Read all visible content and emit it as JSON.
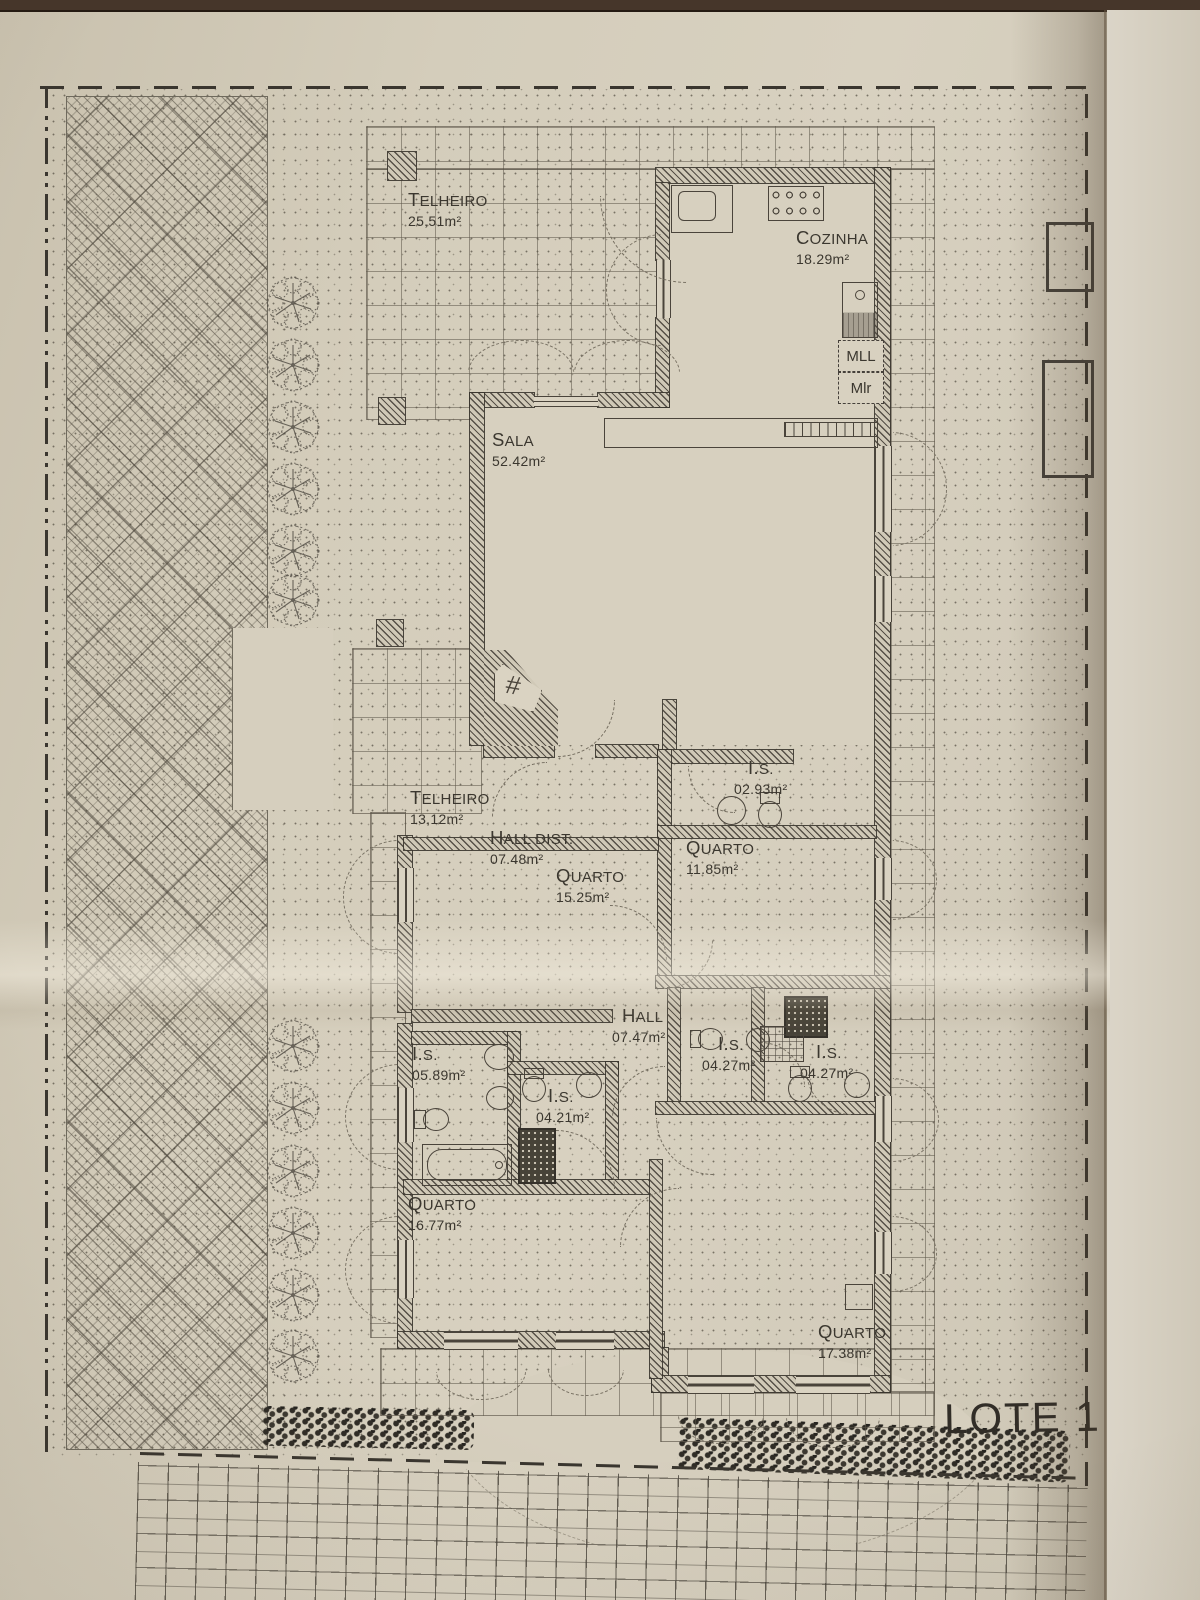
{
  "site": {
    "lote1": "LOTE 1",
    "lote2": "LOTE 2"
  },
  "kitchen_labels": {
    "mll": "MLL",
    "mlr": "Mlr"
  },
  "symbols": {
    "hash": "#"
  },
  "rooms": [
    {
      "name": "TELHEIRO",
      "area": "25,51m²"
    },
    {
      "name": "COZINHA",
      "area": "18.29m²"
    },
    {
      "name": "SALA",
      "area": "52.42m²"
    },
    {
      "name": "TELHEIRO",
      "area": "13,12m²"
    },
    {
      "name": "HALL DIST.",
      "area": "07.48m²"
    },
    {
      "name": "QUARTO",
      "area": "15.25m²"
    },
    {
      "name": "I.S.",
      "area": "02.93m²"
    },
    {
      "name": "QUARTO",
      "area": "11.85m²"
    },
    {
      "name": "HALL",
      "area": "07.47m²"
    },
    {
      "name": "I.S.",
      "area": "04.27m²"
    },
    {
      "name": "I.S.",
      "area": "04.27m²"
    },
    {
      "name": "I.S.",
      "area": "05.89m²"
    },
    {
      "name": "I.S.",
      "area": "04.21m²"
    },
    {
      "name": "QUARTO",
      "area": "16.77m²"
    },
    {
      "name": "QUARTO",
      "area": "17.38m²"
    }
  ],
  "colors": {
    "paper": "#d6cfbe",
    "ink": "#3c3831",
    "wall_hatch": "#565047",
    "hedge": "#2f2c26"
  }
}
